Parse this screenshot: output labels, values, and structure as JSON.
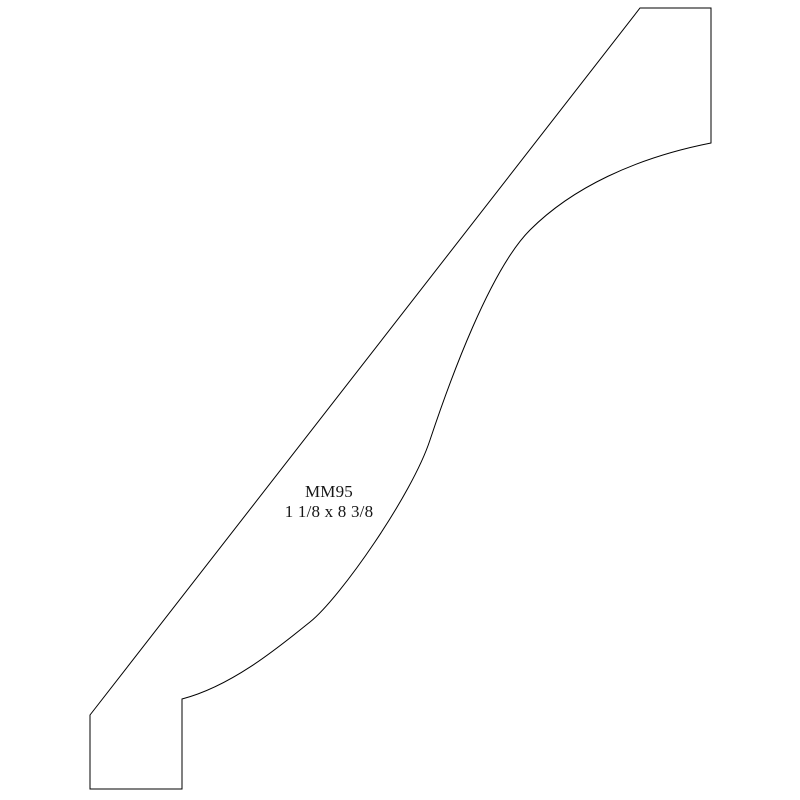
{
  "page": {
    "background_color": "#ffffff"
  },
  "diagram": {
    "label": {
      "code": "MM95",
      "size": "1 1/8 x 8 3/8"
    },
    "outline": {
      "stroke_color": "#000000",
      "stroke_width": 1,
      "fill": "none",
      "path": "M 640 8 L 711 8 L 711 143 C 635 158 572 188 530 230 C 490 270 450 380 430 440 C 412 495 340 598 310 622 C 279 647 232 686 182 699 L 182 789 L 90 789 L 90 715 Z"
    }
  }
}
